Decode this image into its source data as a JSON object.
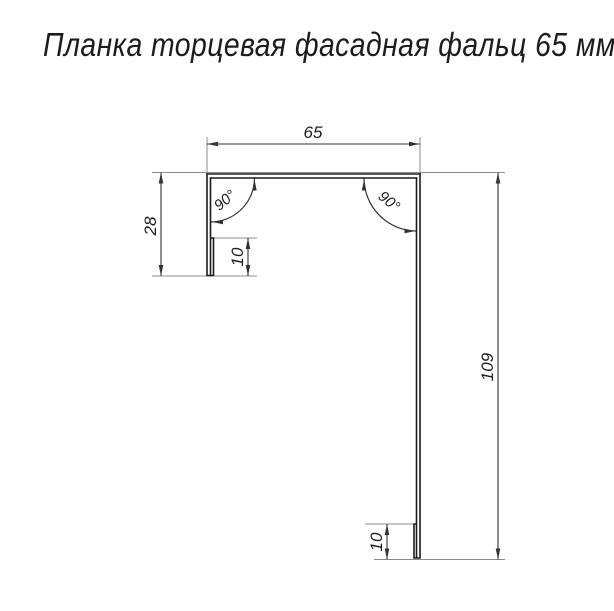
{
  "title": "Планка торцевая фасадная фальц 65 мм",
  "drawing": {
    "dimensions": {
      "top_width": "65",
      "left_height": "28",
      "left_hem": "10",
      "right_height": "109",
      "bottom_hem": "10"
    },
    "angles": {
      "left": "90°",
      "right": "90°"
    }
  },
  "colors": {
    "background": "#ffffff",
    "profile_line": "#1c1c1c",
    "dimension_line": "#333333",
    "extension_line": "#8c8c8c",
    "text": "#1c1c1c"
  }
}
